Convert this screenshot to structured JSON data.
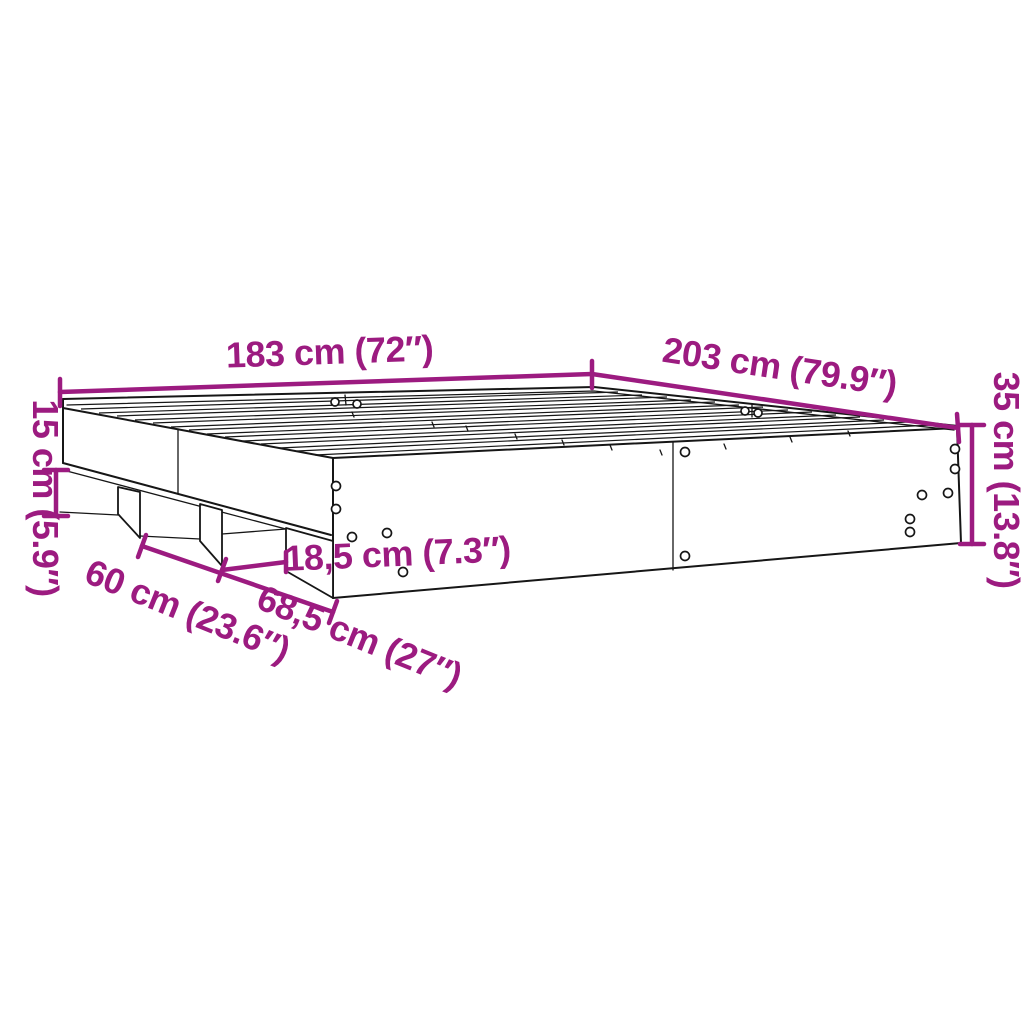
{
  "diagram": {
    "title": "Bed frame dimensions diagram",
    "colors": {
      "dimension_accent": "#9C1B80",
      "line": "#161616",
      "background": "#ffffff"
    },
    "dimensions": {
      "width": {
        "label": "183 cm (72″)"
      },
      "length": {
        "label": "203 cm (79.9″)"
      },
      "height": {
        "label": "35 cm (13.8″)"
      },
      "clearance": {
        "label": "15 cm (5.9″)"
      },
      "support_gap": {
        "label": "18,5 cm (7.3″)"
      },
      "span_left": {
        "label": "60 cm (23.6″)"
      },
      "span_right": {
        "label": "68,5 cm (27″)"
      }
    }
  }
}
